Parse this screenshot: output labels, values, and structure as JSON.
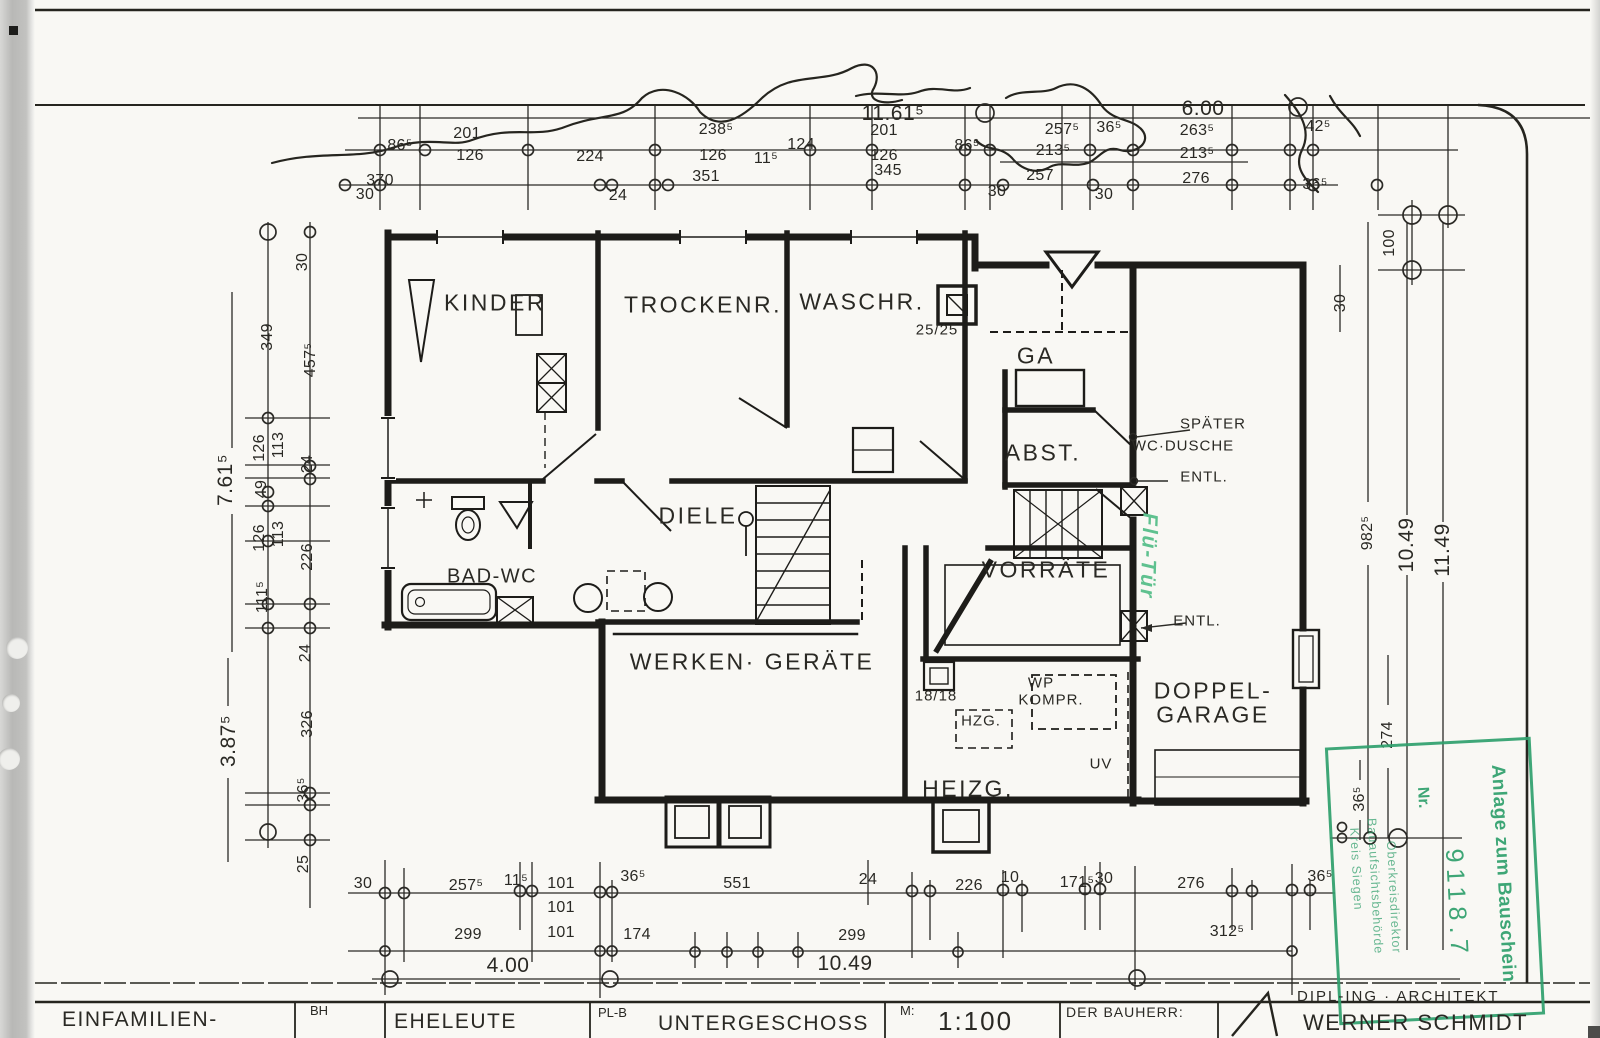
{
  "drawing": {
    "kind": "Architekten-Bauplan (gescannt)",
    "sheet_title": "UNTERGESCHOSS",
    "scale": "1:100"
  },
  "colors": {
    "ink": "#26251f",
    "paper": "#f9f8f4",
    "stamp_green": "#2fa06c",
    "handwriting_green": "#5fc18f"
  },
  "rooms": [
    {
      "text": "KINDER",
      "x": 495,
      "y": 303
    },
    {
      "text": "TROCKENR.",
      "x": 703,
      "y": 305
    },
    {
      "text": "WASCHR.",
      "x": 862,
      "y": 302
    },
    {
      "text": "GA",
      "x": 1036,
      "y": 356
    },
    {
      "text": "ABST.",
      "x": 1043,
      "y": 453
    },
    {
      "text": "DIELE",
      "x": 698,
      "y": 516
    },
    {
      "text": "BAD-WC",
      "x": 492,
      "y": 577,
      "cls": "sm"
    },
    {
      "text": "VORRÄTE",
      "x": 1046,
      "y": 570
    },
    {
      "text": "WERKEN· GERÄTE",
      "x": 752,
      "y": 662
    },
    {
      "text": "HEIZG.",
      "x": 968,
      "y": 789
    },
    {
      "text": "DOPPEL-",
      "x": 1213,
      "y": 691
    },
    {
      "text": "GARAGE",
      "x": 1213,
      "y": 715
    }
  ],
  "annotations": [
    {
      "text": "25/25",
      "x": 937,
      "y": 330
    },
    {
      "text": "SPÄTER",
      "x": 1213,
      "y": 424
    },
    {
      "text": "WC·DUSCHE",
      "x": 1183,
      "y": 446
    },
    {
      "text": "ENTL.",
      "x": 1204,
      "y": 477
    },
    {
      "text": "ENTL.",
      "x": 1197,
      "y": 621
    },
    {
      "text": "18/18",
      "x": 936,
      "y": 696
    },
    {
      "text": "HZG.",
      "x": 981,
      "y": 721
    },
    {
      "text": "WP",
      "x": 1041,
      "y": 683
    },
    {
      "text": "KOMPR.",
      "x": 1051,
      "y": 700
    },
    {
      "text": "UV",
      "x": 1101,
      "y": 764
    }
  ],
  "dim_labels": [
    {
      "text": "11.61⁵",
      "x": 893,
      "y": 114,
      "cls": "big"
    },
    {
      "text": "6.00",
      "x": 1203,
      "y": 109,
      "cls": "big"
    },
    {
      "text": "86⁵",
      "x": 400,
      "y": 146
    },
    {
      "text": "201",
      "x": 467,
      "y": 134
    },
    {
      "text": "126",
      "x": 470,
      "y": 156
    },
    {
      "text": "224",
      "x": 590,
      "y": 157
    },
    {
      "text": "238⁵",
      "x": 716,
      "y": 130
    },
    {
      "text": "126",
      "x": 713,
      "y": 156
    },
    {
      "text": "11⁵",
      "x": 766,
      "y": 159
    },
    {
      "text": "124",
      "x": 801,
      "y": 145
    },
    {
      "text": "201",
      "x": 884,
      "y": 131
    },
    {
      "text": "126",
      "x": 884,
      "y": 156
    },
    {
      "text": "86⁵",
      "x": 967,
      "y": 146
    },
    {
      "text": "370",
      "x": 380,
      "y": 181
    },
    {
      "text": "351",
      "x": 706,
      "y": 177
    },
    {
      "text": "345",
      "x": 888,
      "y": 171
    },
    {
      "text": "30",
      "x": 365,
      "y": 195
    },
    {
      "text": "24",
      "x": 618,
      "y": 196
    },
    {
      "text": "30",
      "x": 997,
      "y": 192
    },
    {
      "text": "257⁵",
      "x": 1062,
      "y": 130
    },
    {
      "text": "213⁵",
      "x": 1053,
      "y": 151
    },
    {
      "text": "257",
      "x": 1040,
      "y": 176
    },
    {
      "text": "30",
      "x": 1104,
      "y": 195
    },
    {
      "text": "36⁵",
      "x": 1109,
      "y": 128
    },
    {
      "text": "263⁵",
      "x": 1197,
      "y": 131
    },
    {
      "text": "213⁵",
      "x": 1197,
      "y": 154
    },
    {
      "text": "276",
      "x": 1196,
      "y": 179
    },
    {
      "text": "42⁵",
      "x": 1318,
      "y": 127
    },
    {
      "text": "36⁵",
      "x": 1315,
      "y": 185
    },
    {
      "text": "30",
      "x": 303,
      "y": 262,
      "rot": -90
    },
    {
      "text": "349",
      "x": 268,
      "y": 337,
      "rot": -90
    },
    {
      "text": "457⁵",
      "x": 311,
      "y": 360,
      "rot": -90
    },
    {
      "text": "7.61⁵",
      "x": 226,
      "y": 480,
      "rot": -90,
      "cls": "big"
    },
    {
      "text": "126",
      "x": 260,
      "y": 448,
      "rot": -90
    },
    {
      "text": "113",
      "x": 279,
      "y": 445,
      "rot": -90
    },
    {
      "text": "49",
      "x": 262,
      "y": 489,
      "rot": -90
    },
    {
      "text": "24",
      "x": 308,
      "y": 464,
      "rot": -90
    },
    {
      "text": "126",
      "x": 260,
      "y": 538,
      "rot": -90
    },
    {
      "text": "113",
      "x": 279,
      "y": 534,
      "rot": -90
    },
    {
      "text": "226",
      "x": 308,
      "y": 557,
      "rot": -90
    },
    {
      "text": "111⁵",
      "x": 263,
      "y": 597,
      "rot": -90
    },
    {
      "text": "24",
      "x": 306,
      "y": 653,
      "rot": -90
    },
    {
      "text": "3.87⁵",
      "x": 229,
      "y": 741,
      "rot": -90,
      "cls": "big"
    },
    {
      "text": "326",
      "x": 308,
      "y": 724,
      "rot": -90
    },
    {
      "text": "36⁵",
      "x": 304,
      "y": 790,
      "rot": -90
    },
    {
      "text": "25",
      "x": 304,
      "y": 864,
      "rot": -90
    },
    {
      "text": "100",
      "x": 1390,
      "y": 243,
      "rot": -90
    },
    {
      "text": "30",
      "x": 1341,
      "y": 303,
      "rot": -90
    },
    {
      "text": "982⁵",
      "x": 1368,
      "y": 533,
      "rot": -90
    },
    {
      "text": "10.49",
      "x": 1407,
      "y": 545,
      "rot": -90,
      "cls": "big"
    },
    {
      "text": "11.49",
      "x": 1443,
      "y": 550,
      "rot": -90,
      "cls": "big"
    },
    {
      "text": "274",
      "x": 1388,
      "y": 735,
      "rot": -90
    },
    {
      "text": "36⁵",
      "x": 1360,
      "y": 799,
      "rot": -90
    },
    {
      "text": "30",
      "x": 363,
      "y": 884
    },
    {
      "text": "257⁵",
      "x": 466,
      "y": 886
    },
    {
      "text": "11⁵",
      "x": 516,
      "y": 881
    },
    {
      "text": "101",
      "x": 561,
      "y": 884
    },
    {
      "text": "36⁵",
      "x": 633,
      "y": 877
    },
    {
      "text": "551",
      "x": 737,
      "y": 884
    },
    {
      "text": "24",
      "x": 868,
      "y": 880
    },
    {
      "text": "226",
      "x": 969,
      "y": 886
    },
    {
      "text": "10",
      "x": 1010,
      "y": 878
    },
    {
      "text": "171⁵",
      "x": 1077,
      "y": 883
    },
    {
      "text": "30",
      "x": 1104,
      "y": 879
    },
    {
      "text": "276",
      "x": 1191,
      "y": 884
    },
    {
      "text": "36⁵",
      "x": 1320,
      "y": 877
    },
    {
      "text": "101",
      "x": 561,
      "y": 908
    },
    {
      "text": "299",
      "x": 468,
      "y": 935
    },
    {
      "text": "101",
      "x": 561,
      "y": 933
    },
    {
      "text": "174",
      "x": 637,
      "y": 935
    },
    {
      "text": "299",
      "x": 852,
      "y": 936
    },
    {
      "text": "312⁵",
      "x": 1227,
      "y": 932
    },
    {
      "text": "4.00",
      "x": 508,
      "y": 966,
      "cls": "big"
    },
    {
      "text": "10.49",
      "x": 845,
      "y": 964,
      "cls": "big"
    }
  ],
  "stamp": {
    "title": "Anlage zum Bauschein",
    "nr_label": "Nr.",
    "number": "9118.7",
    "authority_lines": [
      {
        "text": "Kreis Siegen",
        "x": 22,
        "y": 120,
        "rot": 90
      },
      {
        "text": "Bauaufsichtsbehörde",
        "x": 40,
        "y": 138,
        "rot": 90
      },
      {
        "text": "Oberkreisdirektor",
        "x": 58,
        "y": 150,
        "rot": 90
      }
    ]
  },
  "handwriting": {
    "text": "Flü-Tür"
  },
  "title_block": {
    "project": "EINFAMILIEN-",
    "bh_label": "BH",
    "client": "EHELEUTE",
    "plb_label": "PL-B",
    "sheet": "UNTERGESCHOSS",
    "scale_label": "M:",
    "scale_value": "1:100",
    "bauherr_label": "DER BAUHERR:",
    "architect_title": "DIPL-ING · ARCHITEKT",
    "architect_name": "WERNER SCHMIDT"
  }
}
